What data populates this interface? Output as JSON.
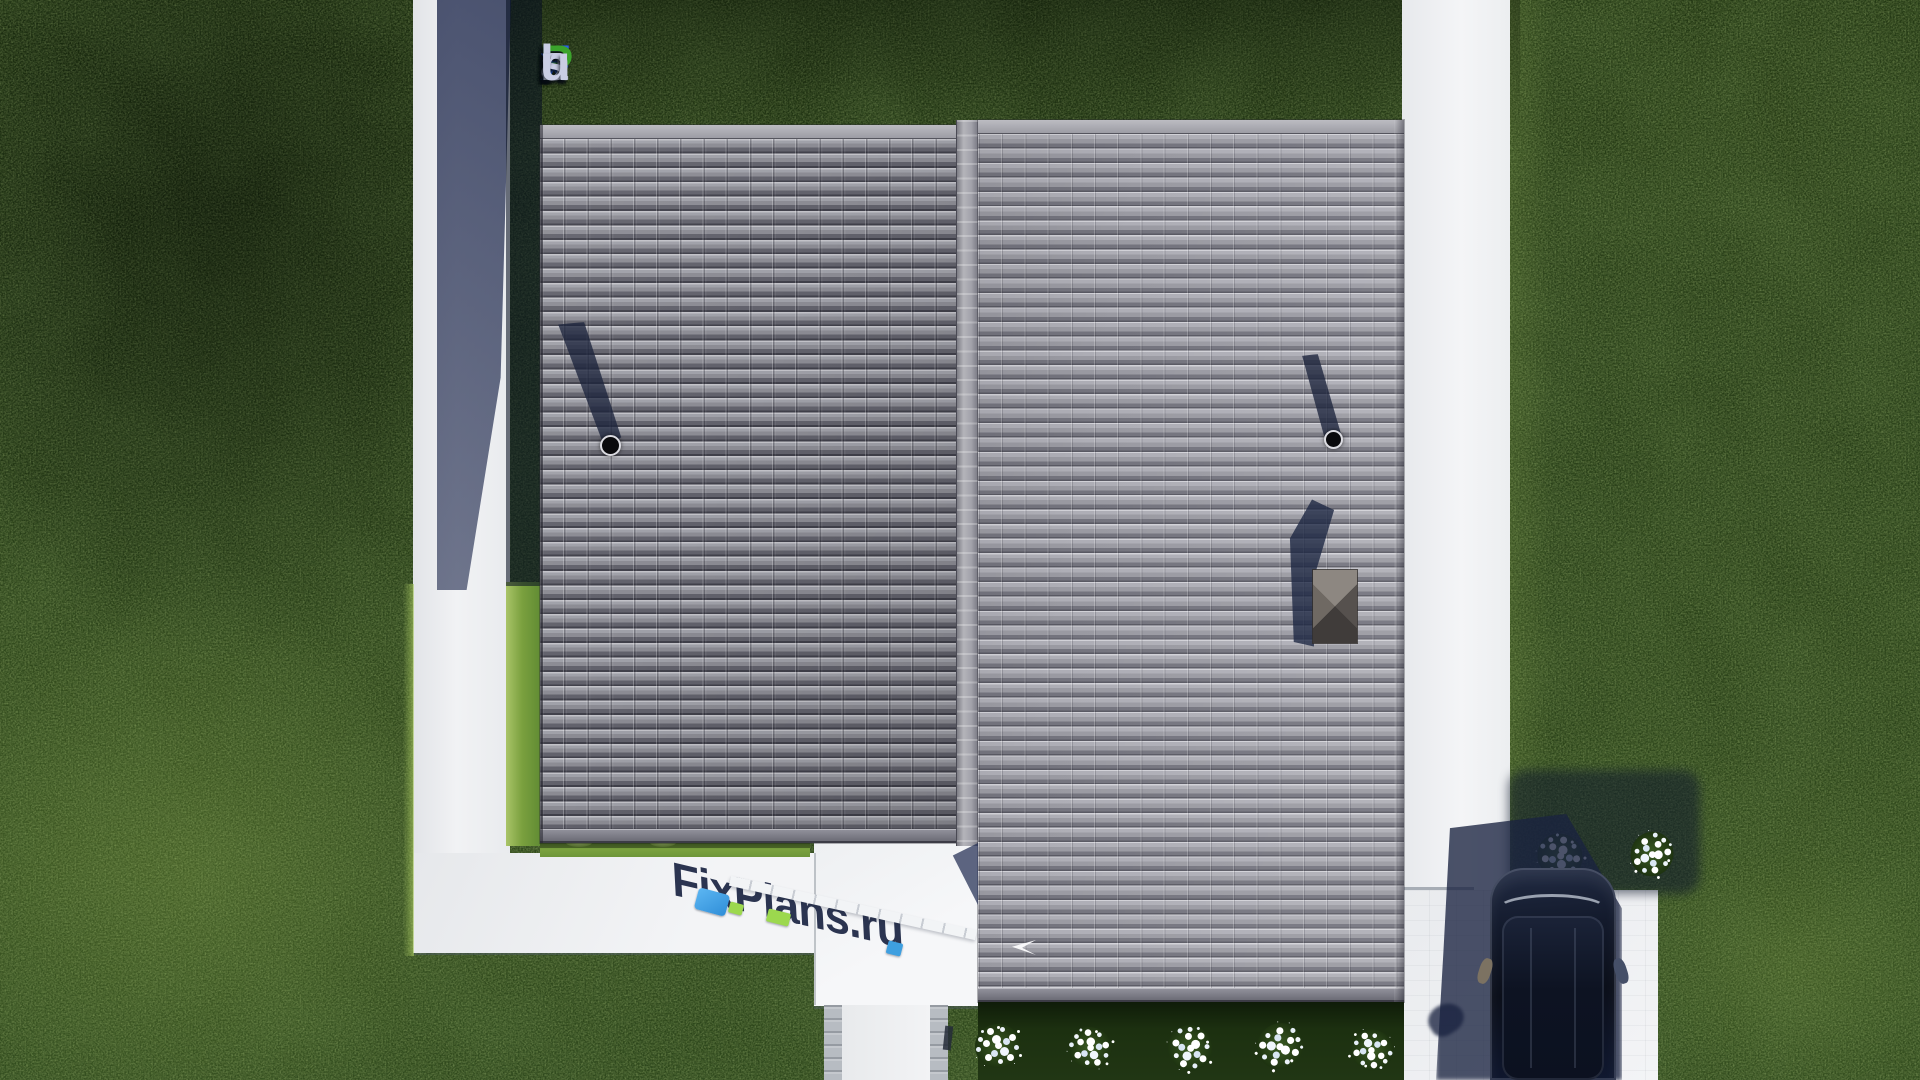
{
  "watermark": {
    "text": "FixPlans.ru",
    "letters": [
      {
        "ch": "F",
        "color": "#2a62e8"
      },
      {
        "ch": "i",
        "color": "#c9cde4"
      },
      {
        "ch": "x",
        "color": "#2a62e8"
      },
      {
        "ch": "P",
        "color": "#3ba32c"
      },
      {
        "ch": "l",
        "color": "#c9cde4"
      },
      {
        "ch": "a",
        "color": "#c9cde4"
      },
      {
        "ch": "n",
        "color": "#c9cde4"
      },
      {
        "ch": "s",
        "color": "#c9cde4"
      },
      {
        "ch": ".",
        "color": "#2a62e8"
      },
      {
        "ch": "r",
        "color": "#c9cde4"
      },
      {
        "ch": "u",
        "color": "#c9cde4"
      }
    ]
  },
  "ground_logo": {
    "text": "FixPlans.ru",
    "shadow_color": "#2b3450",
    "accent_blue": "#3e9fe0",
    "accent_green": "#9cd84e"
  },
  "scene": {
    "view": "top-down architectural render",
    "roof_sections": 2,
    "chimney_vents": 2,
    "roof_hatches": 1,
    "flower_bushes": 7,
    "cars": 1
  },
  "colors": {
    "grass": "#263b16",
    "roof_left": "#85858d",
    "roof_right": "#9a9aa2",
    "paving": "#edeff1",
    "cast_shadow": "#2b3450",
    "car_body": "#0d1220"
  }
}
